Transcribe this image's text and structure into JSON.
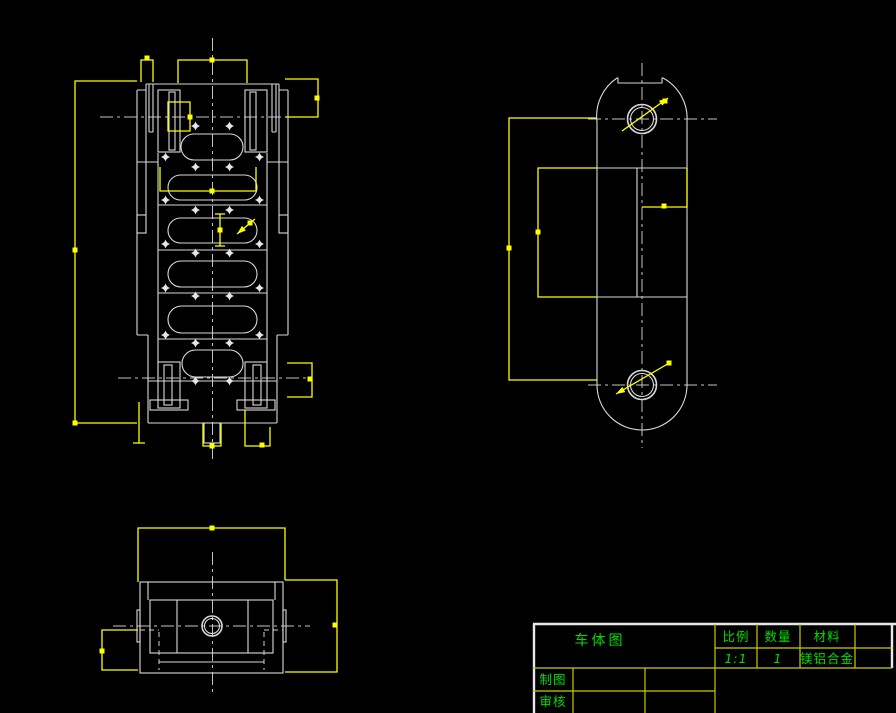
{
  "app": {
    "background": "#000000"
  },
  "colors": {
    "geometry": "#d9d9d9",
    "centerline": "#c3c3c3",
    "selection_highlight": "#ffff00",
    "grip": "#ffff00",
    "table_grid": "#cbcb00",
    "table_border": "#e8e8e8",
    "text": "#00dd00"
  },
  "title_block": {
    "name": "车体图",
    "scale_label": "比例",
    "scale_value": "1:1",
    "qty_label": "数量",
    "qty_value": "1",
    "material_label": "材料",
    "material_value": "镁铝合金",
    "drafter_label": "制图",
    "checker_label": "审核"
  },
  "front_view": {
    "slots": [
      {
        "x": 181,
        "y": 134,
        "w": 62,
        "h": 26
      },
      {
        "x": 168,
        "y": 175,
        "w": 89,
        "h": 25
      },
      {
        "x": 168,
        "y": 218,
        "w": 89,
        "h": 25
      },
      {
        "x": 168,
        "y": 261,
        "w": 89,
        "h": 26
      },
      {
        "x": 168,
        "y": 306,
        "w": 89,
        "h": 27
      },
      {
        "x": 182,
        "y": 350,
        "w": 61,
        "h": 27
      }
    ],
    "hole_markers": [
      [
        195.5,
        126
      ],
      [
        229.5,
        126
      ],
      [
        165.5,
        157
      ],
      [
        259.5,
        157
      ],
      [
        195.5,
        167
      ],
      [
        229.5,
        167
      ],
      [
        165.5,
        200
      ],
      [
        259.5,
        200
      ],
      [
        195.5,
        210
      ],
      [
        229.5,
        210
      ],
      [
        165.5,
        244
      ],
      [
        259.5,
        244
      ],
      [
        195.5,
        253
      ],
      [
        229.5,
        253
      ],
      [
        165.5,
        288
      ],
      [
        259.5,
        288
      ],
      [
        195.5,
        296
      ],
      [
        229.5,
        296
      ],
      [
        165.5,
        335
      ],
      [
        259.5,
        335
      ],
      [
        195.5,
        343
      ],
      [
        229.5,
        343
      ],
      [
        195.5,
        381
      ],
      [
        229.5,
        381
      ]
    ]
  },
  "side_view": {
    "top_hole": {
      "cx": 642,
      "cy": 119,
      "r_outer": 14.5,
      "r_inner": 11.5
    },
    "bottom_hole": {
      "cx": 642,
      "cy": 385,
      "r_outer": 14.5,
      "r_inner": 11.5
    }
  },
  "bottom_view": {
    "center_hole": {
      "cx": 212,
      "cy": 626,
      "r_outer": 10,
      "r_inner": 7.5
    }
  },
  "selection": {
    "grips": [
      [
        147,
        58
      ],
      [
        212,
        60
      ],
      [
        317,
        98
      ],
      [
        190,
        117
      ],
      [
        75,
        250
      ],
      [
        212,
        191
      ],
      [
        220,
        230
      ],
      [
        250,
        223
      ],
      [
        310,
        379
      ],
      [
        262,
        445
      ],
      [
        212,
        446
      ],
      [
        75,
        423
      ],
      [
        509,
        248
      ],
      [
        538,
        232
      ],
      [
        664,
        206
      ],
      [
        665,
        101
      ],
      [
        669,
        363
      ],
      [
        212,
        528
      ],
      [
        335,
        625
      ],
      [
        102,
        651
      ]
    ],
    "leaders": [
      {
        "tip": [
          237,
          234
        ],
        "tail": [
          255,
          219
        ]
      },
      {
        "tip": [
          668,
          98
        ],
        "tail": [
          622,
          131
        ]
      },
      {
        "tip": [
          616,
          394
        ],
        "tail": [
          671,
          362
        ]
      }
    ]
  }
}
